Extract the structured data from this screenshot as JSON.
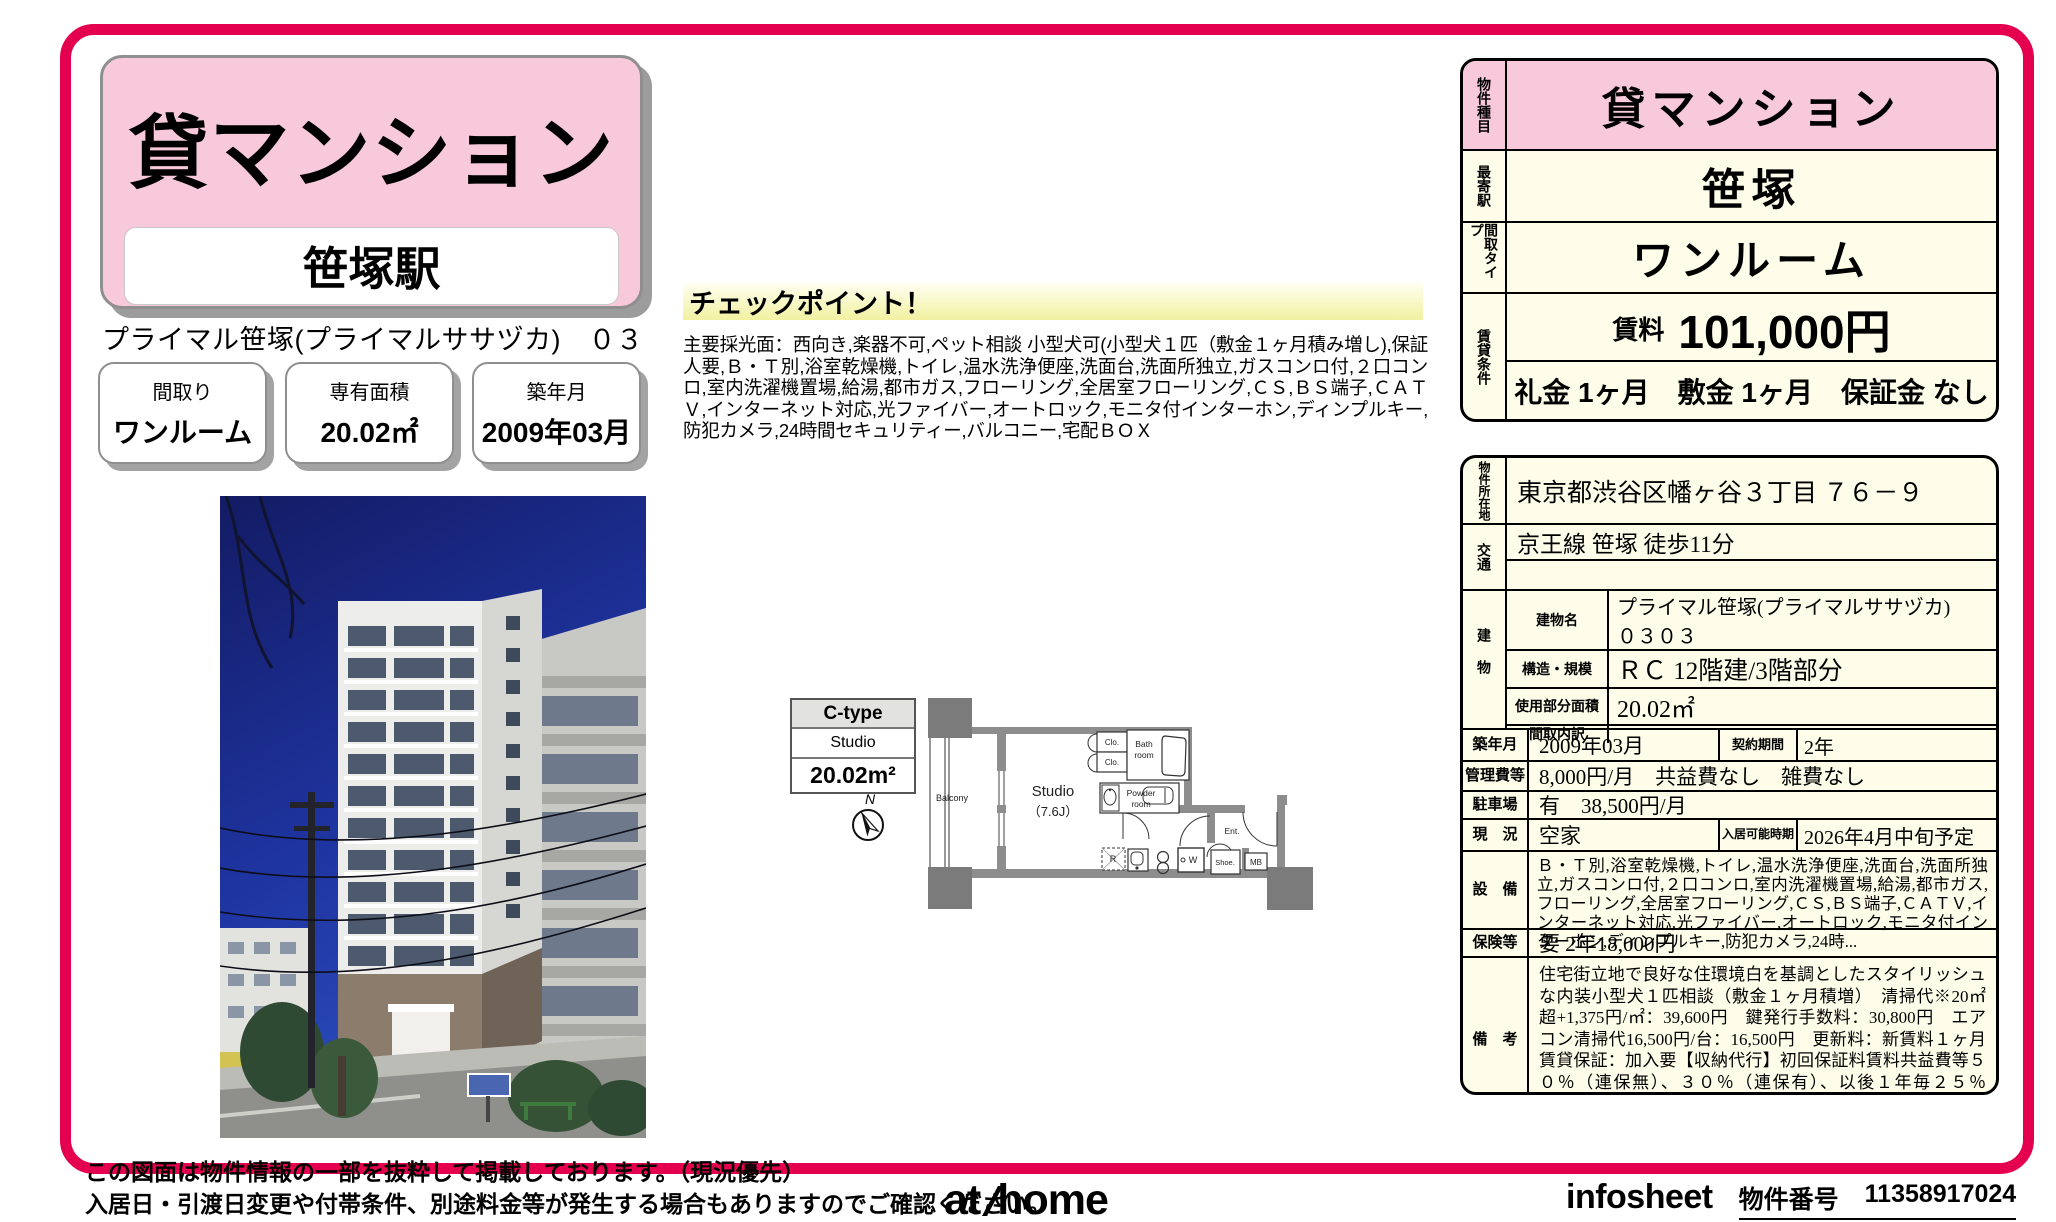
{
  "colors": {
    "frame": "#e4004f",
    "pink": "#f8c9db",
    "cream": "#fdfde9"
  },
  "header": {
    "category": "貸マンション",
    "station": "笹塚駅",
    "property_line": "プライマル笹塚(プライマルササヅカ)　０３０３"
  },
  "quick_facts": [
    {
      "label": "間取り",
      "value": "ワンルーム"
    },
    {
      "label": "専有面積",
      "value": "20.02㎡"
    },
    {
      "label": "築年月",
      "value": "2009年03月"
    }
  ],
  "checkpoint": {
    "heading": "チェックポイント！",
    "body": "主要採光面：西向き,楽器不可,ペット相談 小型犬可(小型犬１匹（敷金１ヶ月積み増し),保証人要,Ｂ・Ｔ別,浴室乾燥機,トイレ,温水洗浄便座,洗面台,洗面所独立,ガスコンロ付,２口コンロ,室内洗濯機置場,給湯,都市ガス,フローリング,全居室フローリング,ＣＳ,ＢＳ端子,ＣＡＴＶ,インターネット対応,光ファイバー,オートロック,モニタ付インターホン,ディンプルキー,防犯カメラ,24時間セキュリティー,バルコニー,宅配ＢＯＸ"
  },
  "floorplan": {
    "type": "C-type",
    "layout": "Studio",
    "area": "20.02m²",
    "compass": "N",
    "labels": {
      "balcony": "Balcony",
      "studio": "Studio",
      "studio_size": "（7.6J）",
      "clo1": "Clo.",
      "clo2": "Clo.",
      "bath": [
        "Bath",
        "room"
      ],
      "powder": [
        "Powder",
        "room"
      ],
      "ent": "Ent.",
      "shoe": "Shoe.",
      "mb": "MB",
      "w": "W",
      "r": "R"
    }
  },
  "summary_table": {
    "rows": [
      {
        "label": "物件種目",
        "value": "貸マンション"
      },
      {
        "label": "最寄駅",
        "value": "笹塚"
      },
      {
        "label": "間取タイプ",
        "value": "ワンルーム"
      }
    ],
    "terms": {
      "label": "賃貸条件",
      "rent_label": "賃料",
      "rent_value": "101,000円",
      "deposit_line": "礼金 1ヶ月　敷金 1ヶ月　保証金 なし"
    }
  },
  "detail_table": {
    "location": {
      "label": "物件所在地",
      "value": "東京都渋谷区幡ヶ谷３丁目 ７６－９"
    },
    "access": {
      "label": "交通",
      "line1": "京王線 笹塚 徒歩11分",
      "line2": ""
    },
    "building": {
      "label": "建物",
      "rows": [
        {
          "label": "建物名",
          "value": "プライマル笹塚(プライマルササヅカ)　０３０３"
        },
        {
          "label": "構造・規模",
          "value": "ＲＣ 12階建/3階部分"
        },
        {
          "label": "使用部分面積",
          "value": "20.02㎡"
        },
        {
          "label": "間取内訳",
          "value": ""
        }
      ]
    },
    "built": {
      "label": "築年月",
      "value": "2009年03月",
      "sub_label": "契約期間",
      "sub_value": "2年"
    },
    "fees": {
      "label": "管理費等",
      "value": "8,000円/月　共益費なし　雑費なし"
    },
    "parking": {
      "label": "駐車場",
      "value": "有　38,500円/月"
    },
    "status": {
      "label": "現　況",
      "value": "空家",
      "sub_label": "入居可能時期",
      "sub_value": "2026年4月中旬予定"
    },
    "equipment": {
      "label": "設　備",
      "value": "Ｂ・Ｔ別,浴室乾燥機,トイレ,温水洗浄便座,洗面台,洗面所独立,ガスコンロ付,２口コンロ,室内洗濯機置場,給湯,都市ガス,フローリング,全居室フローリング,ＣＳ,ＢＳ端子,ＣＡＴＶ,インターネット対応,光ファイバー,オートロック,モニタ付インターホン,ディンプルキー,防犯カメラ,24時..."
    },
    "insurance": {
      "label": "保険等",
      "value": "要 2年18,000円"
    },
    "remarks": {
      "label": "備　考",
      "value": "住宅街立地で良好な住環境白を基調としたスタイリッシュな内装小型犬１匹相談（敷金１ヶ月積増）　清掃代※20㎡超+1,375円/㎡：39,600円　鍵発行手数料：30,800円　エアコン清掃代16,500円/台：16,500円　更新料：新賃料１ヶ月　賃貸保証：加入要【収納代行】初回保証料賃料共益費等５０％（連保無）、３０％（連保有）、以後１年毎２５％　月々口座振替　利用駅１：京王線 幡ヶ谷 徒歩13分"
    }
  },
  "footer": {
    "disclaimer1": "この図面は物件情報の一部を抜粋して掲載しております。（現況優先）",
    "disclaimer2": "入居日・引渡日変更や付帯条件、別途料金等が発生する場合もありますのでご確認ください。",
    "logo_at": "at",
    "logo_home": "home",
    "infosheet": "infosheet",
    "property_no_label": "物件番号",
    "property_no": "11358917024"
  }
}
